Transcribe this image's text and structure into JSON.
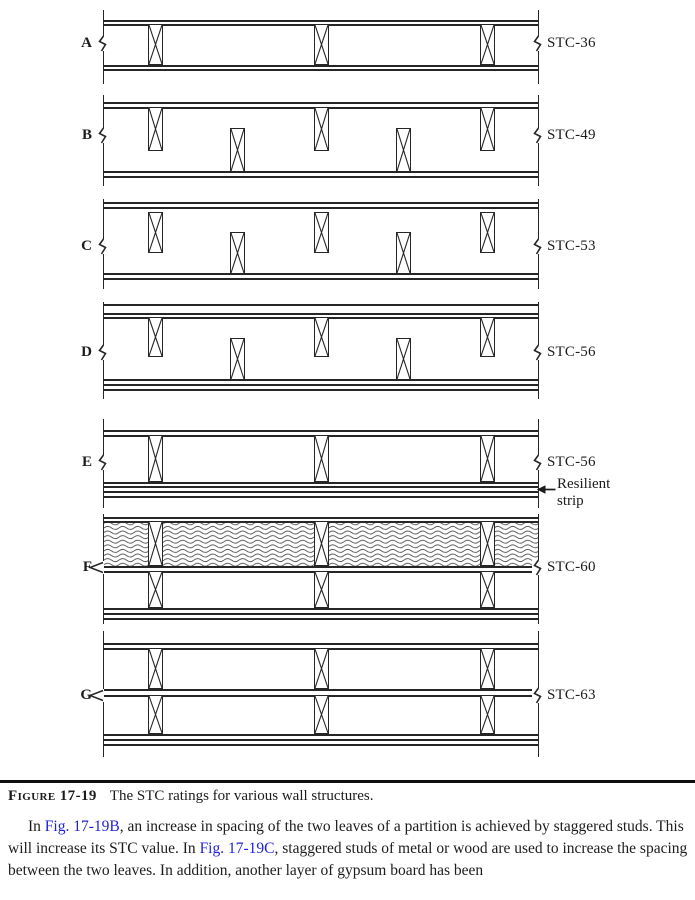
{
  "figure": {
    "walls": [
      {
        "label": "A",
        "stc": "STC-36"
      },
      {
        "label": "B",
        "stc": "STC-49"
      },
      {
        "label": "C",
        "stc": "STC-53"
      },
      {
        "label": "D",
        "stc": "STC-56"
      },
      {
        "label": "E",
        "stc": "STC-56"
      },
      {
        "label": "F",
        "stc": "STC-60"
      },
      {
        "label": "G",
        "stc": "STC-63"
      }
    ],
    "annotation": {
      "line1": "Resilient",
      "line2": "strip"
    },
    "icons": {
      "break_mark": "zigzag-break",
      "wall_leader": "left-open-arrow",
      "resilient_leader": "left-solid-arrow"
    }
  },
  "caption": {
    "label": "Figure 17-19",
    "text": "The STC ratings for various wall structures."
  },
  "paragraph": {
    "pre1": "In ",
    "link1": "Fig. 17-19B",
    "mid": ", an increase in spacing of the two leaves of a partition is achieved by staggered studs. This will increase its STC value. In ",
    "link2": "Fig. 17-19C",
    "post": ", staggered studs of metal or wood are used to increase the spacing between the two leaves. In addition, another layer of gypsum board has been"
  },
  "colors": {
    "link": "#2121dd",
    "ink": "#1c1c1c"
  }
}
